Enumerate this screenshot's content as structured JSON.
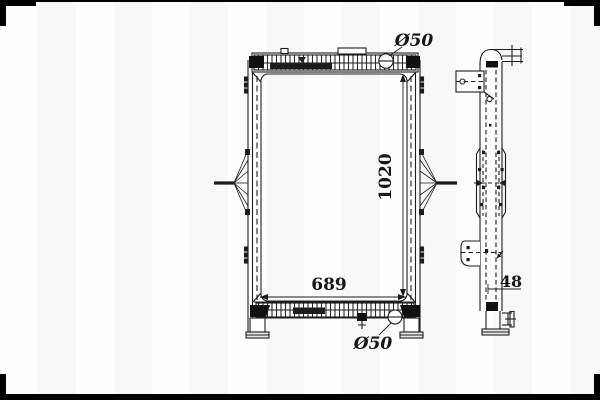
{
  "page": {
    "type": "technical-drawing",
    "subject": "truck radiator - front and side orthographic views",
    "background_color": "#fdfdfd",
    "line_color": "#1d1d1d",
    "frame_color": "#000000"
  },
  "front_view": {
    "labels": {
      "top_port": "Ø50",
      "bottom_port": "Ø50",
      "core_height": "1020",
      "core_width": "689"
    }
  },
  "side_view": {
    "labels": {
      "depth": "48"
    }
  }
}
